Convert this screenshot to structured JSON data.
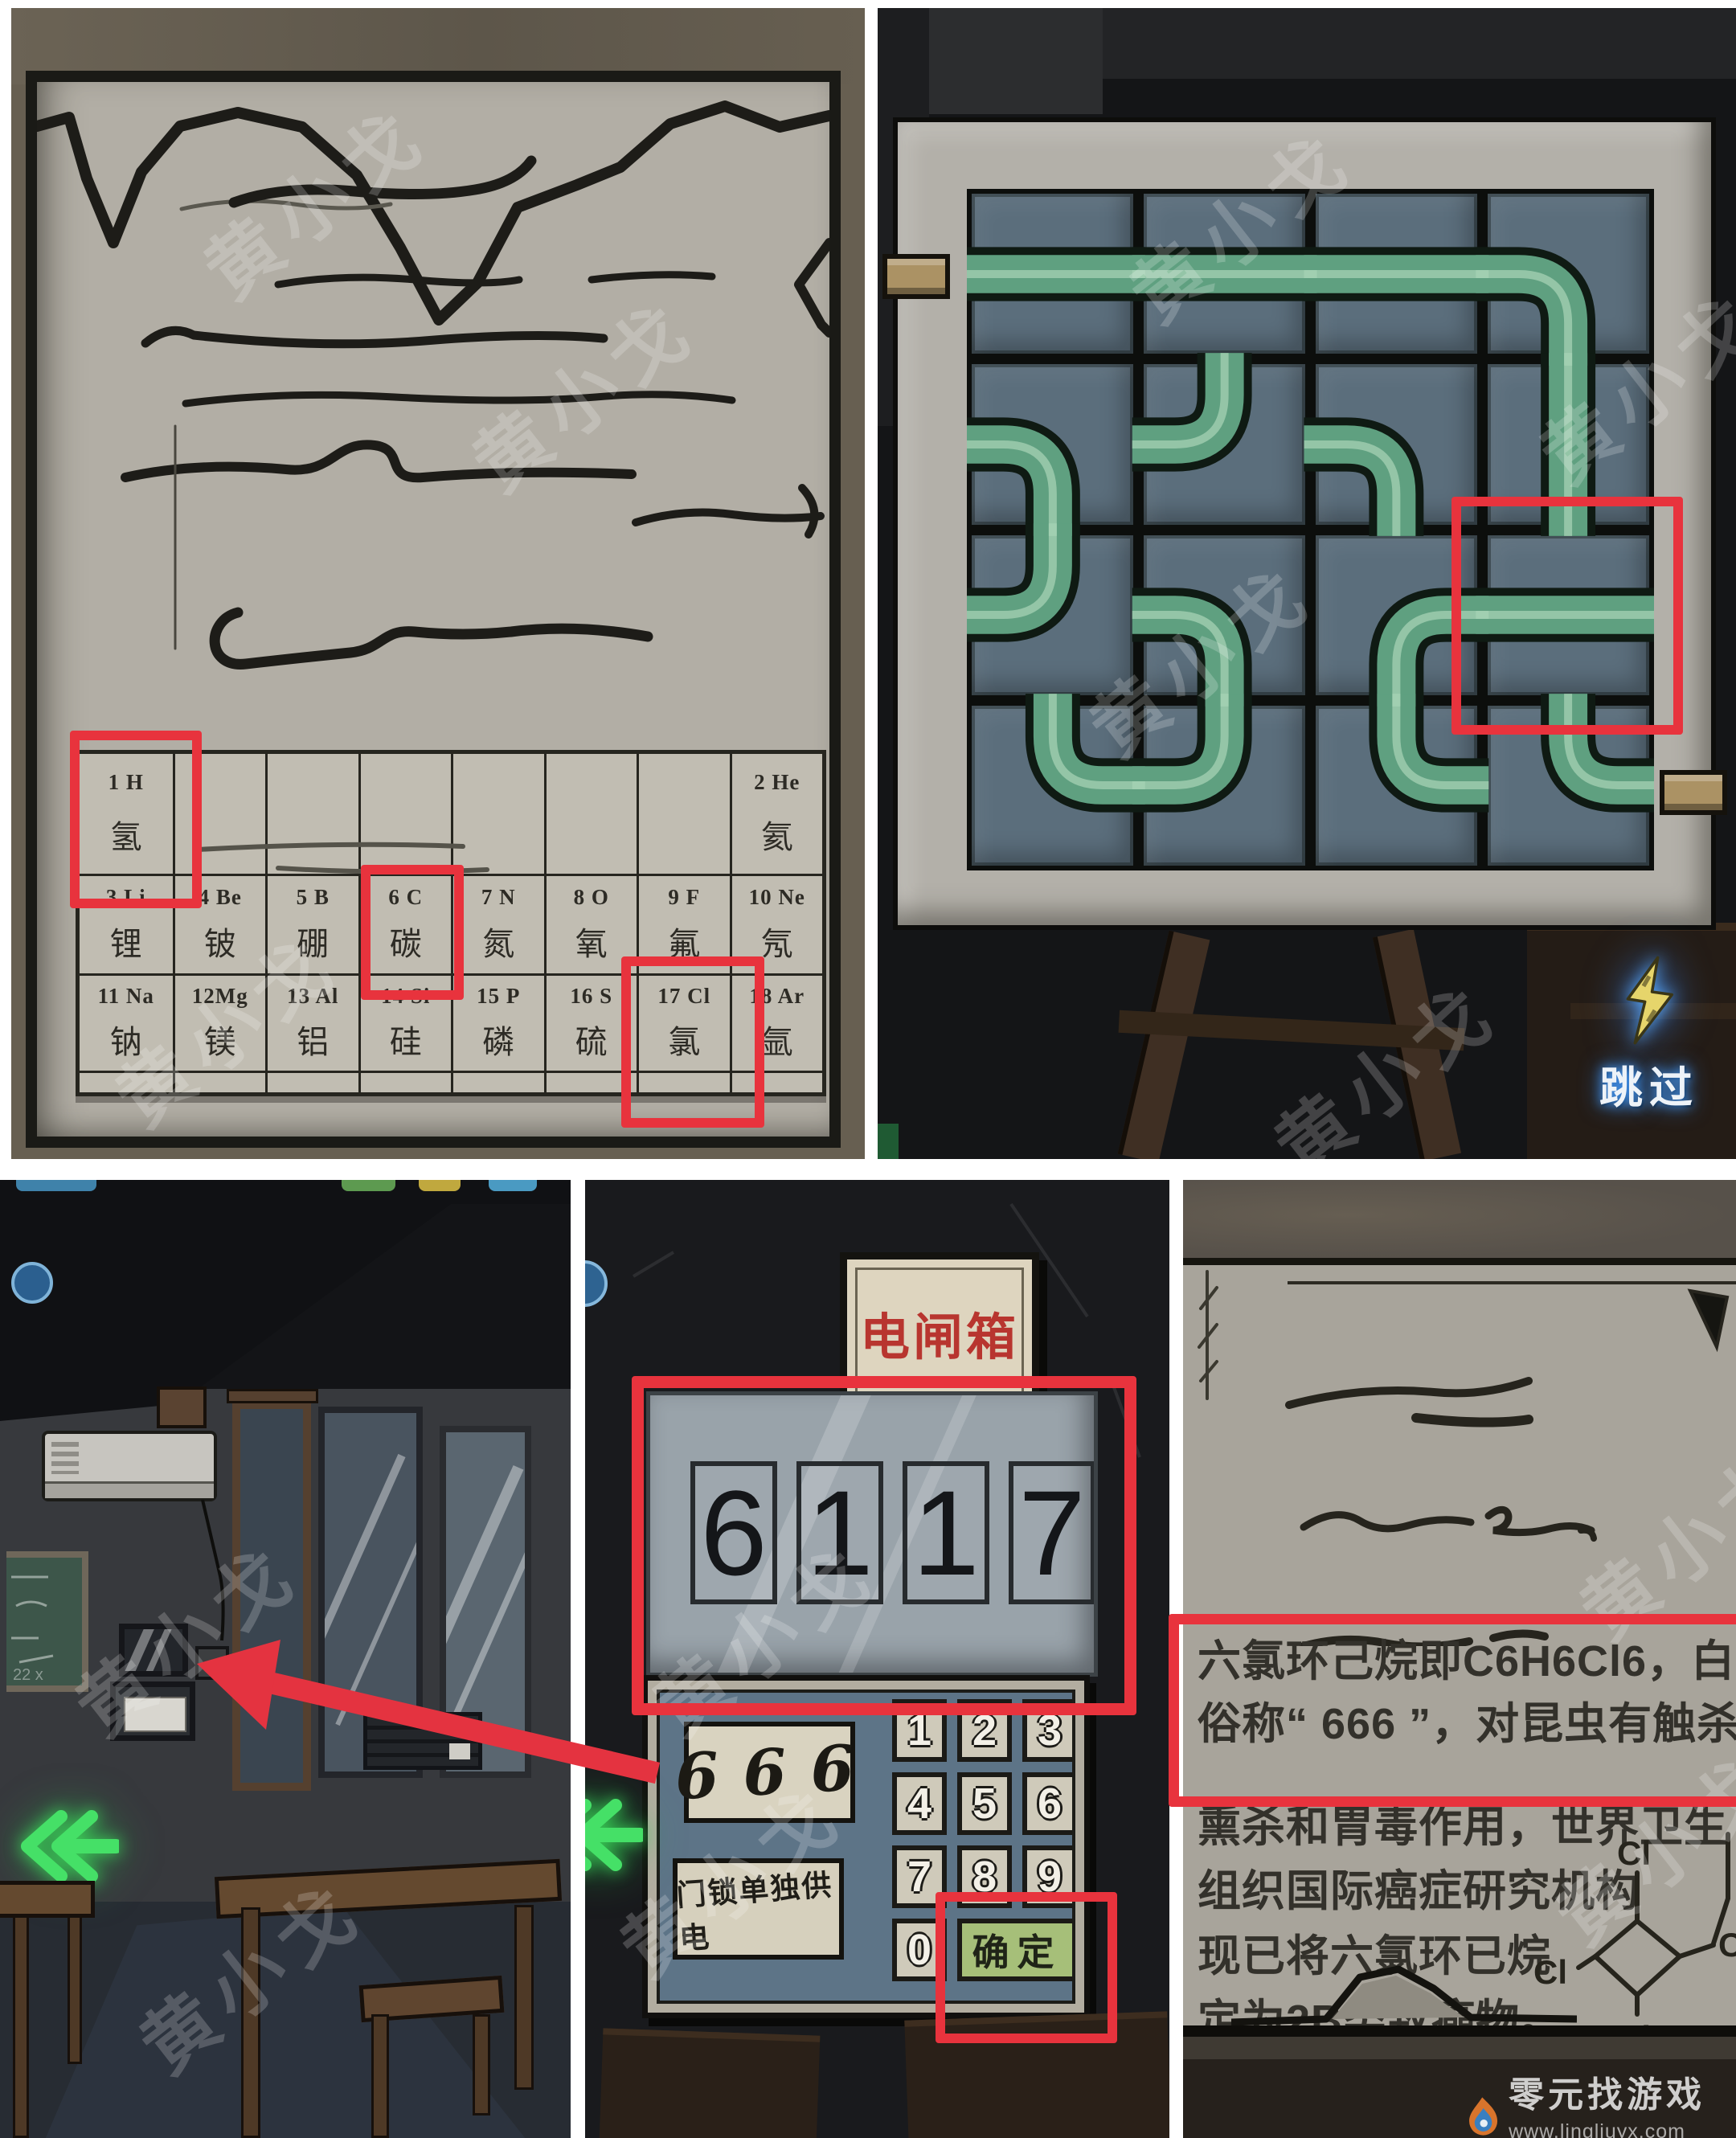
{
  "watermark": {
    "text": "黄小戈"
  },
  "logo": {
    "brand": "零元找游戏",
    "urls": "www.lingliuyx.com   www.06zyx.com"
  },
  "colors": {
    "accent_red": "#e8333d",
    "pipe_green": "#5fa080",
    "tile_blue": "#5b6e7c",
    "sign_red": "#b8352f",
    "confirm_green": "#a6bf79",
    "glow_blue": "#4aa0ff",
    "nav_green": "#45e067"
  },
  "note": {
    "periodic": {
      "rows": [
        {
          "cells": [
            {
              "num": "1 H",
              "name": "氢"
            },
            {},
            {},
            {},
            {},
            {},
            {},
            {
              "num": "2 He",
              "name": "氦"
            }
          ]
        },
        {
          "cells": [
            {
              "num": "3 Li",
              "name": "锂"
            },
            {
              "num": "4 Be",
              "name": "铍"
            },
            {
              "num": "5 B",
              "name": "硼"
            },
            {
              "num": "6 C",
              "name": "碳"
            },
            {
              "num": "7 N",
              "name": "氮"
            },
            {
              "num": "8 O",
              "name": "氧"
            },
            {
              "num": "9 F",
              "name": "氟"
            },
            {
              "num": "10 Ne",
              "name": "氖"
            }
          ]
        },
        {
          "cells": [
            {
              "num": "11 Na",
              "name": "钠"
            },
            {
              "num": "12Mg",
              "name": "镁"
            },
            {
              "num": "13 Al",
              "name": "铝"
            },
            {
              "num": "14 Si",
              "name": "硅"
            },
            {
              "num": "15 P",
              "name": "磷"
            },
            {
              "num": "16 S",
              "name": "硫"
            },
            {
              "num": "17 Cl",
              "name": "氯"
            },
            {
              "num": "18 Ar",
              "name": "氩"
            }
          ]
        }
      ],
      "highlighted_elements": [
        "1 H 氢",
        "6 C 碳",
        "17 Cl 氯"
      ]
    }
  },
  "pipes": {
    "skip_label": "跳过",
    "grid_size": 4,
    "cells": [
      [
        "h",
        "h",
        "h",
        "lb"
      ],
      [
        "lb",
        "tl",
        "lb",
        "v"
      ],
      [
        "tl",
        "lb",
        "rb",
        "h"
      ],
      [
        "tr",
        "tl",
        "tr",
        "tr"
      ]
    ],
    "highlight_cell": {
      "row": 2,
      "col": 3
    },
    "inlet_side": "left-row1",
    "outlet_side": "right-row4"
  },
  "classroom": {
    "nav_arrow": "left"
  },
  "breaker": {
    "sign": "电闸箱",
    "display_digits": [
      "6",
      "1",
      "1",
      "7"
    ],
    "code_display": "666",
    "label": "门锁单独供电",
    "keys": [
      "1",
      "2",
      "3",
      "4",
      "5",
      "6",
      "7",
      "8",
      "9"
    ],
    "zero_key": "0",
    "confirm_label": "确定"
  },
  "chem": {
    "lines": [
      "六氯环己烷即C6H6Cl6，白色晶体",
      "俗称“ 666 ”，对昆虫有触杀、",
      "熏杀和胃毒作用，世界卫生",
      "组织国际癌症研究机构",
      "现已将六氯环已烷",
      "定为2B类致癌物。"
    ],
    "atom_labels": [
      "Cl",
      "Cl",
      "Cl",
      "C"
    ]
  }
}
